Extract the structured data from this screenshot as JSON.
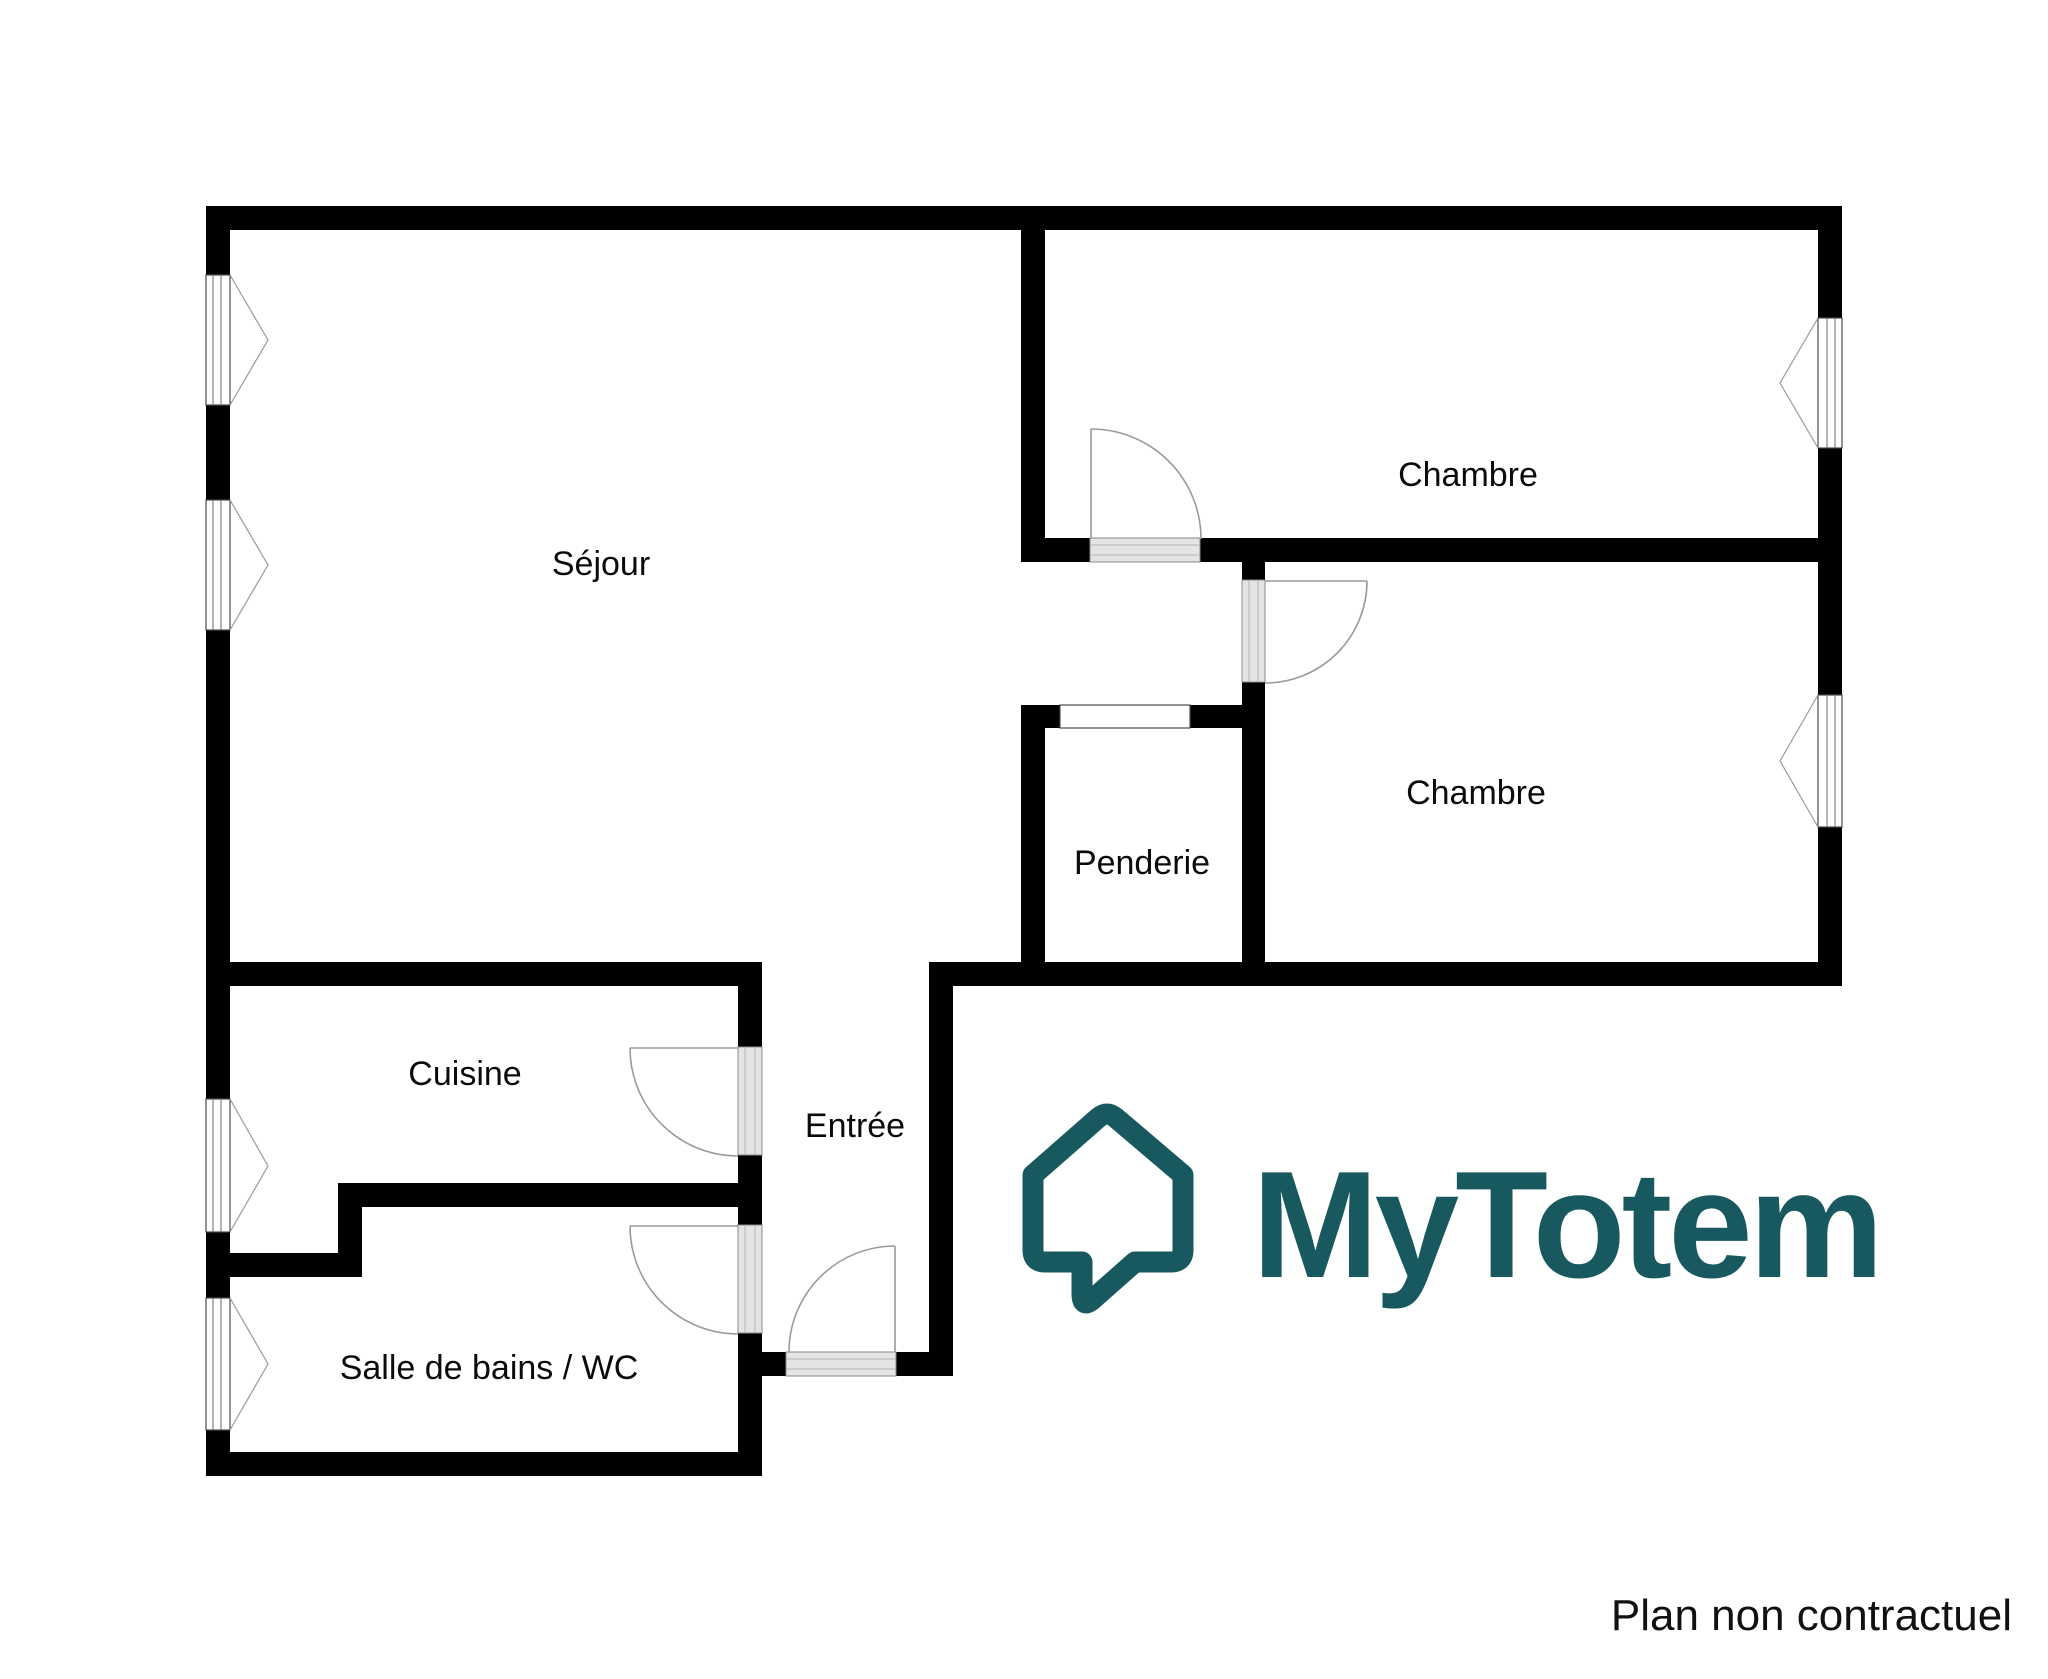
{
  "plan": {
    "rooms": {
      "sejour": {
        "label": "Séjour"
      },
      "chambre_top": {
        "label": "Chambre"
      },
      "chambre_right": {
        "label": "Chambre"
      },
      "penderie": {
        "label": "Penderie"
      },
      "cuisine": {
        "label": "Cuisine"
      },
      "salle_de_bains": {
        "label": "Salle de bains / WC"
      },
      "entree": {
        "label": "Entrée"
      }
    },
    "wall_color": "#000000",
    "door_symbol_color": "#9a9a9a",
    "threshold_color": "#e4e4e4"
  },
  "branding": {
    "logo_text": "MyTotem",
    "brand_color": "#17595f"
  },
  "footer": {
    "disclaimer": "Plan non contractuel",
    "text_color": "#111111"
  }
}
